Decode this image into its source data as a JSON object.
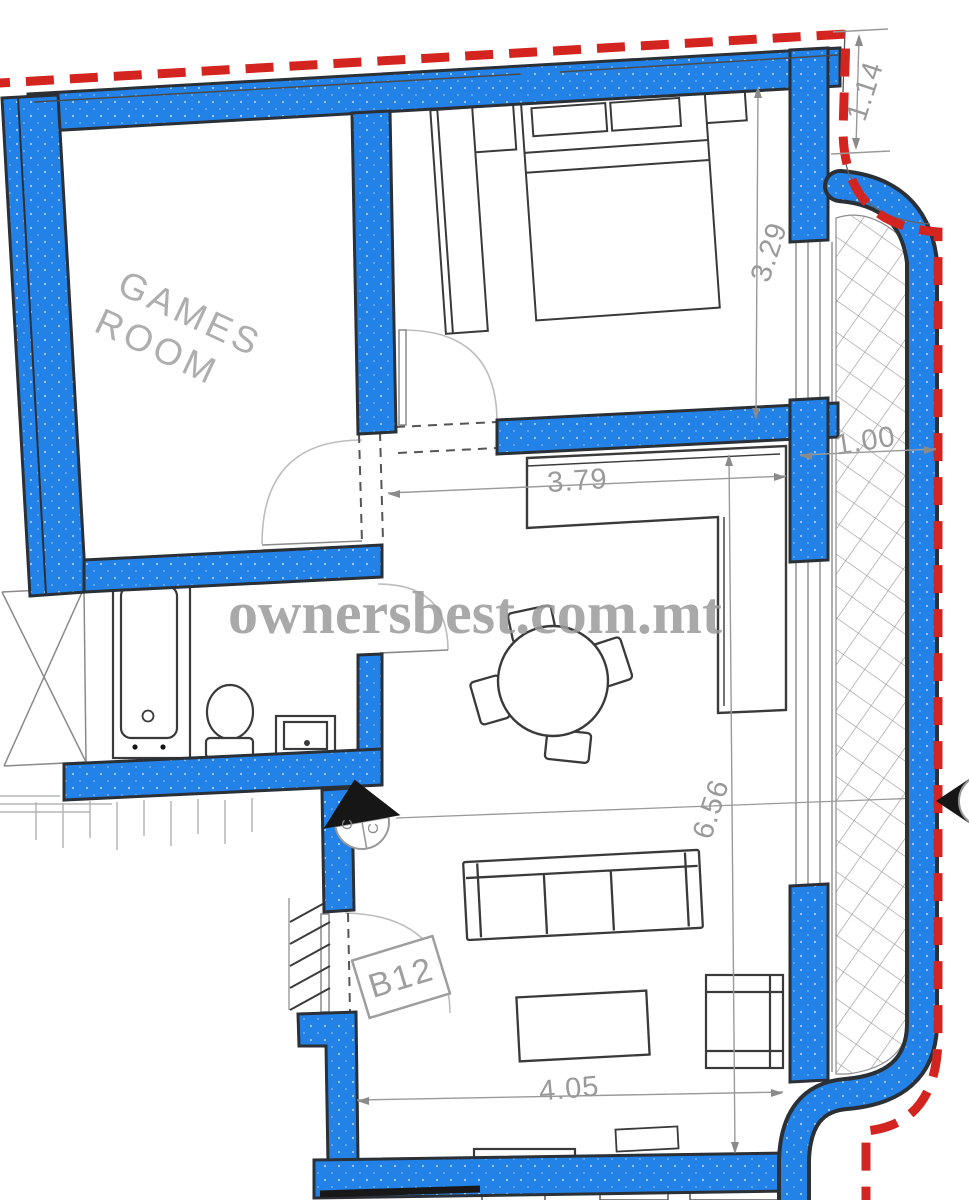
{
  "plan": {
    "watermark": "ownersbest.com.mt",
    "unit_label": "B12",
    "rooms": {
      "games": {
        "line1": "GAMES",
        "line2": "ROOM"
      }
    },
    "dimensions": {
      "top_right_offset": "1.14",
      "bedroom_depth": "3.29",
      "bedroom_width": "3.79",
      "living_length": "6.56",
      "living_width": "4.05",
      "terrace_width": "1.00"
    },
    "section_marker": {
      "letter_a": "C",
      "letter_b": "C"
    },
    "colors": {
      "wall_fill": "#2382E8",
      "wall_outline": "#2B3036",
      "boundary_red": "#D3241F",
      "furniture_line": "#3A3A3A",
      "dimension_gray": "#9A9A9A",
      "watermark_gray": "#9B9B9B",
      "hatch_gray": "#9A9A9A",
      "marker_black": "#161616"
    }
  }
}
